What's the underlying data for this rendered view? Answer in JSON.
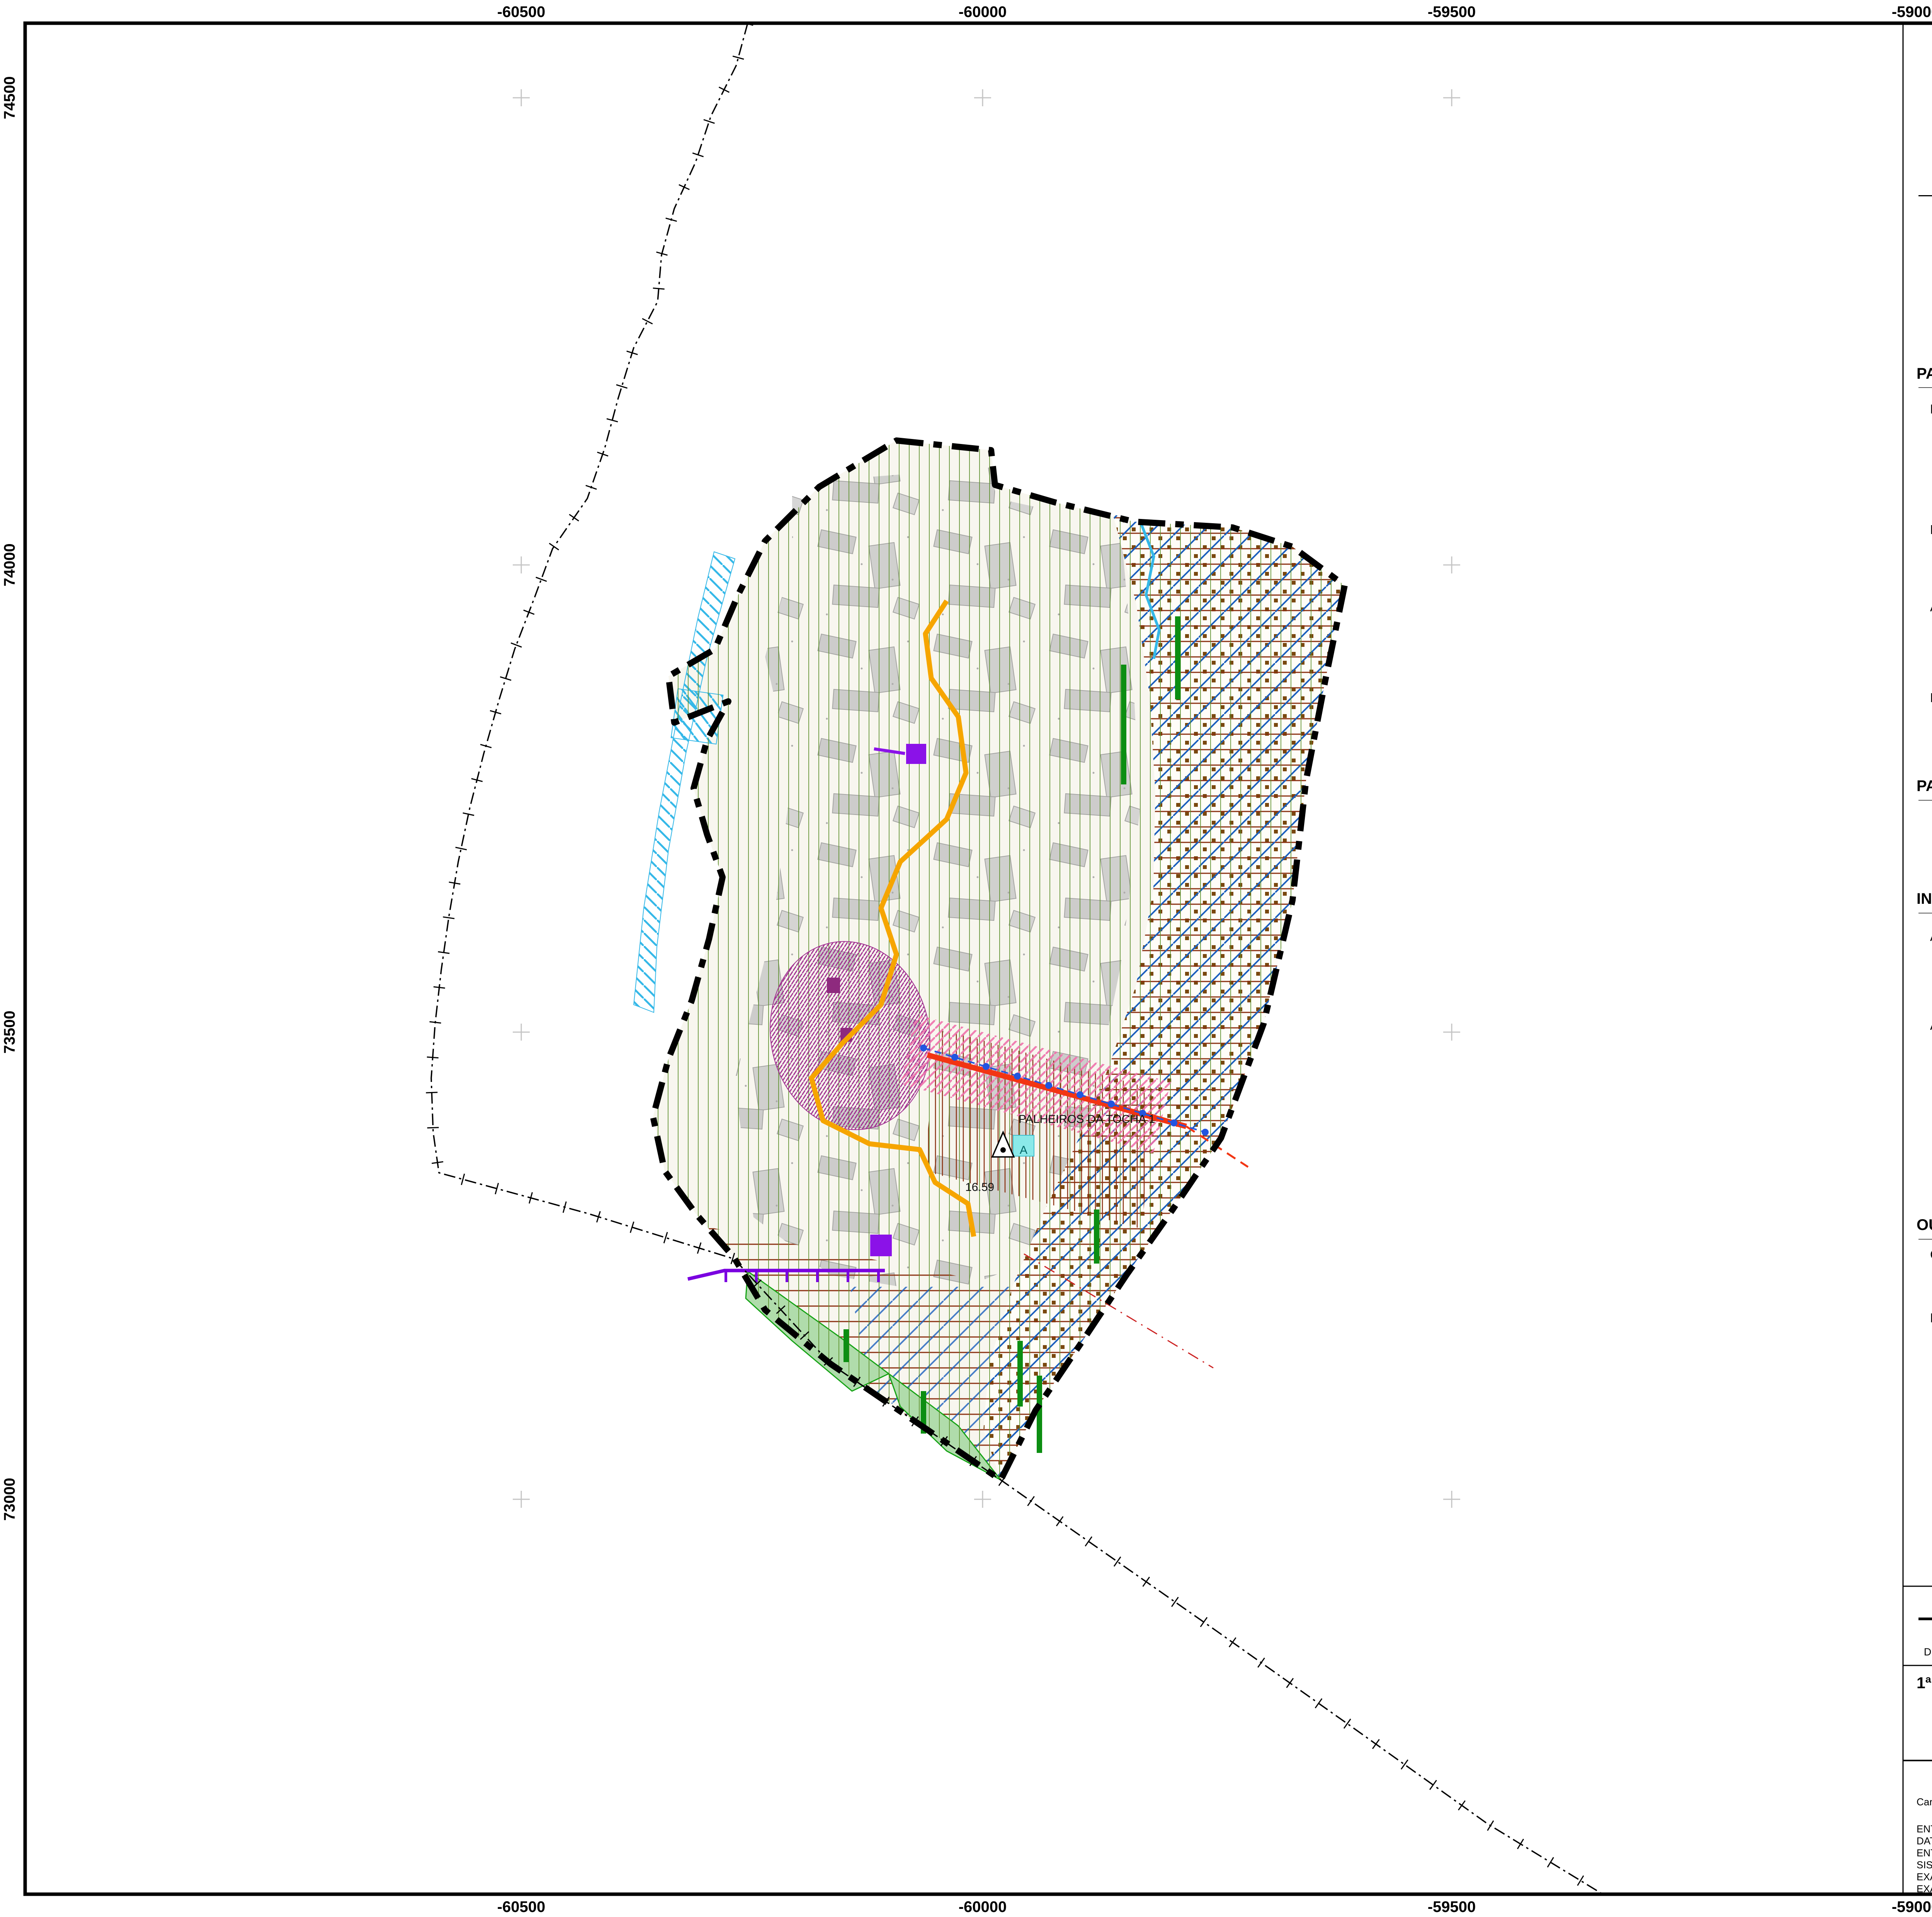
{
  "sheet": {
    "north_label": "N",
    "axes": {
      "top": [
        "-60500",
        "-60000",
        "-59500",
        "-59000"
      ],
      "bottom": [
        "-60500",
        "-60000",
        "-59500",
        "-59000"
      ],
      "left": [
        "74500",
        "74000",
        "73500",
        "73000"
      ]
    },
    "map_labels": {
      "place": "PALHEIROS DA TOCHA 1",
      "elevation": "16.59",
      "storage_letter": "A"
    }
  },
  "legend": {
    "title": "LEGENDA",
    "general": {
      "limite": "Limite do Concelho (CAOP 2024)",
      "carta_base": "Carta Base",
      "hidrografia": "Hidrografia",
      "area_intervencao": "Área de Intervenção do Plano"
    },
    "paisagem": {
      "header": "PAISAGEM E RECURSOS NATURAIS",
      "ren": {
        "header": "RESERVA ECOLÓGICA NACIONAL",
        "dunas": "Dunas",
        "dunas_litorais": "Dunas Litorais",
        "max_infiltracao": "Áreas de Máxima Infiltração"
      },
      "dpm": {
        "header": "DOMÍNIO PÚBLICO MARÍTIMO",
        "margem": "Margem das Águas do Mar"
      },
      "regime_florestal": {
        "header": "ÁREAS SUBMETIDAS AO REGIME FLORESTAL",
        "parcial": "Regime Florestal Parcial - Perímetro Florestal das Dunas de Cantanhede",
        "total": "Regime Florestal Total - Mata Nacional das Dunas de Quiaios"
      },
      "natura": {
        "header": "REDE NATURA 2000",
        "zec_line1": "Zona Especial de Conservação do SIC PTCON0055 - Dunas de Mira, Gândara e Gafanhas",
        "zec_line2": "(Decreto Regulamentar n.º 1/2020, de 16 de março)"
      }
    },
    "patrimonio": {
      "header": "PATRIMÓNIO",
      "ivc": "Imóveis em Vias de Classificação (IVC)",
      "zona_ivc": "Zona Geral Proteção IVC"
    },
    "infraestruturas": {
      "header": "INFRAESTRUTURAS",
      "agua": {
        "header": "ABASTECIMENTO DE ÁGUA",
        "conduta": "Conduta Adutora",
        "armazenamento": "Armazenamento de Água",
        "letter": "A"
      },
      "residuais": {
        "header": "ÁGUAS RESIDUAIS",
        "coletor": "Coletor de Águas Residuais",
        "bombagem": "Bombagem ou Tratamento de Águas Residuais"
      },
      "energia": {
        "header": "ENERGIA ELÉTRICA",
        "aerea_l1": "Infraestrutura de Transporte Energia Elétrica",
        "aerea_l2": "Linha Aérea de Média Tensão",
        "posto_l1": "Infraestrutura de Produção ou Transformação de",
        "posto_l2": "Energia Elétrica - Posto de Transformação público",
        "subterranea_l1": "Infraestrutura de Transporte Energia Elétrica",
        "subterranea_l2": "Linha Subterrânea de Média Tensão"
      },
      "rodoviaria": {
        "header": "REDE RODOVIÁRIA",
        "en335": "Estrada Nacional EN335-1 (desclassificada)",
        "servidao_l1": "Zona de Servidão de Estrada Nacional",
        "servidao_l2": "Desclassificada"
      }
    },
    "outros": {
      "header": "OUTROS ELEMENTOS",
      "cartografia": {
        "header": "CARTOGRAFIA",
        "marco": "Marco Geodésico - \"Palheiros da Tocha 1\" - Bolembreano sobre depósito à cota 16.59"
      },
      "faixas": {
        "header": "FAIXAS DE GESTÃO DE COMBUSTÍVEL",
        "primaria": "Rede primária de faixas de gestão de combustível",
        "secundaria": "Rede secundária de faixas de gestão de combustível"
      }
    }
  },
  "title_block": {
    "brand": "cantanhede.município",
    "department": "DEPARTAMENTO DE URBANISMO",
    "division": "DIVISÃO DE GESTÃO DO TERRITÓRIO E SUSTENTABILIDADE AMBIENTAL",
    "logo_name": "Cantanhede",
    "logo_sub": "Município",
    "title": "1ª ALTERAÇÃO À 1ª REVISÃO DO PLANO DE URBANIZAÇÃO DA PRAIA DA TOCHA",
    "version": "VERSÃO FINAL",
    "sheet_name": "PLANTA DE CONDICIONANTES",
    "escala_label": "escala",
    "escala": "1:5 000",
    "desenho_label": "n.º desenho",
    "desenho": "02",
    "data_label": "data",
    "data": "dezembro 2025",
    "revisao_label": "revisão",
    "revisao": "00",
    "referencia_label": "referência",
    "referencia": "02_PCOND",
    "desenhado_label": "desenhado",
    "escala_grafica_label": "escala gráfica",
    "scale_ticks": [
      "0",
      "50",
      "100",
      "200"
    ],
    "scale_units": "Meters"
  },
  "notes": {
    "heading": "Cartografia base vetorial homologada:",
    "lines": [
      "ENTIDADE PROPRIETÁRIA: Município de Cantanhede",
      "DATA, PROCESSO e RESPONSÁVEL da HOMOLOGAÇÃO: 11/05/2023, n.º 5181, Direção Geral do Território",
      "ENTIDADE PRODUTORA: GEOLAYER - Geoengenharia e Serviços, Lda",
      "SISTEMA DE REFERÊNCIA: PT-TM06/ETRS89  |  Datum Altimétrico - Marégrafo de Cascais",
      "EXATIDÃO POSICIONAL (EMQ): Planimétrica <= 0.30 m e Altimétrica <= 0.40m",
      "EXATIDÃO TEMÁTICA: >=95%"
    ]
  },
  "colors": {
    "accent_cyan": "#3db7e4",
    "hidrografia": "#29c1f0",
    "ivc_fill": "#9c2786",
    "florestal_green": "#0ea510",
    "mata_fill": "#a5d8a8",
    "natura_green": "#5a8f29",
    "orange_line": "#f6a500",
    "red_road": "#f23513",
    "dark_red": "#8a2f10",
    "purple": "#8b12e8",
    "coletor_purple": "#7a00e0",
    "blue": "#2255e0",
    "blue_hatch": "#1b5fbd",
    "cyan_hatch": "#35b8e8",
    "pink": "#ef72ab",
    "dunas_brown": "#7a480f",
    "dunas_tan": "#d2a963"
  }
}
